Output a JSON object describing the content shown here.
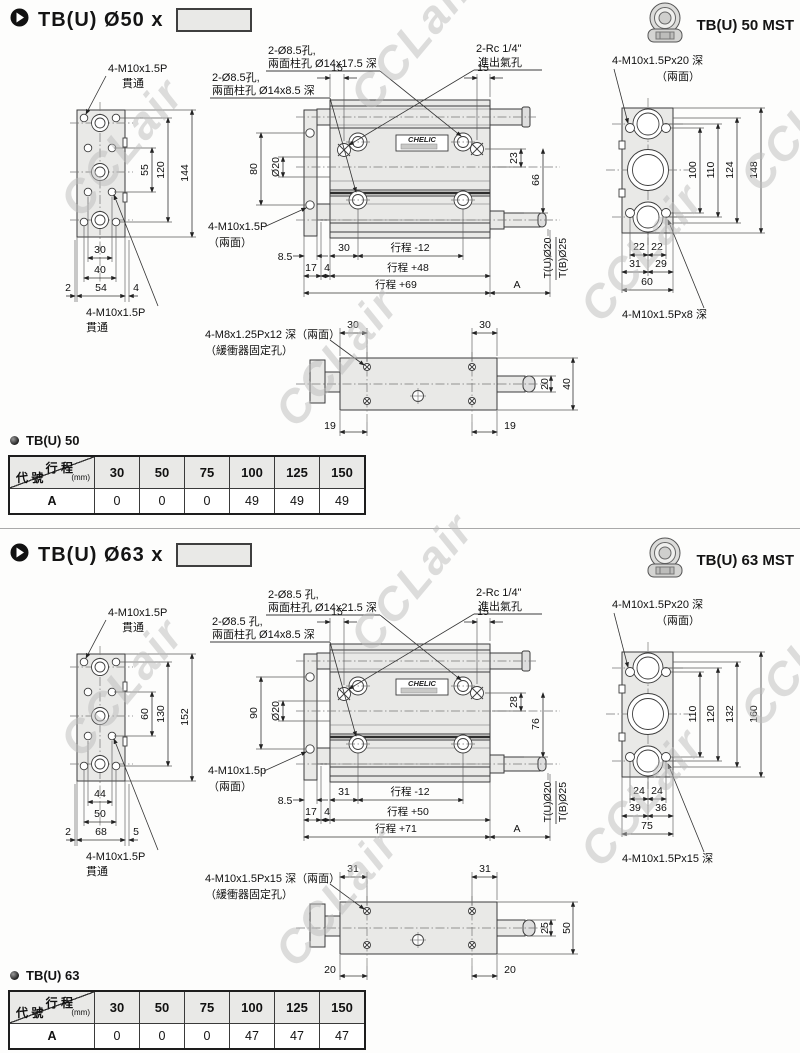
{
  "watermark": "CCLair",
  "section_order": [
    "s50",
    "s63"
  ],
  "sections": {
    "s50": {
      "title": "TB(U) Ø50 x",
      "mst": "TB(U) 50 MST",
      "bullet": "TB(U) 50",
      "lv": {
        "t1": "4-M10x1.5P",
        "t2": "貫通",
        "b1": "4-M10x1.5P",
        "b2": "貫通",
        "v1": "55",
        "v2": "120",
        "v3": "144",
        "h1": "30",
        "h2": "40",
        "e1": "2",
        "e2": "54",
        "e3": "4"
      },
      "fv": {
        "c1a": "2-Ø8.5孔,",
        "c1b": "兩面柱孔 Ø14x17.5 深",
        "c2a": "2-Ø8.5孔,",
        "c2b": "兩面柱孔 Ø14x8.5 深",
        "c3a": "2-Rc 1/4\"",
        "c3b": "進出氣孔",
        "p1": "15",
        "p2": "15",
        "v1": "80",
        "v2": "Ø20",
        "v3": "23",
        "v4": "66",
        "s1": "4-M10x1.5P",
        "s2": "（兩面）",
        "r1a": "8.5",
        "r1b": "30",
        "r1c": "行程 -12",
        "r2a": "17",
        "r2b": "4",
        "r2c": "行程 +48",
        "r3a": "行程 +69",
        "r3b": "A",
        "rod1": "T(U)Ø20",
        "rod2": "T(B)Ø25",
        "plate": "CHELIC"
      },
      "rv": {
        "t1": "4-M10x1.5Px20 深",
        "t2": "（兩面）",
        "v1": "100",
        "v2": "110",
        "v3": "124",
        "v4": "148",
        "h1a": "22",
        "h1b": "22",
        "h2a": "31",
        "h2b": "29",
        "h3": "60",
        "bot": "4-M10x1.5Px8 深"
      },
      "bv": {
        "l1": "4-M8x1.25Px12 深（兩面）",
        "l2": "（緩衝器固定孔）",
        "d1": "30",
        "d2": "30",
        "r1": "20",
        "r2": "40",
        "b1": "19",
        "b2": "19"
      },
      "table": {
        "h_stroke": "行 程",
        "h_unit": "(mm)",
        "h_code": "代 號",
        "cols": [
          "30",
          "50",
          "75",
          "100",
          "125",
          "150"
        ],
        "row": "A",
        "vals": [
          "0",
          "0",
          "0",
          "49",
          "49",
          "49"
        ]
      }
    },
    "s63": {
      "title": "TB(U) Ø63 x",
      "mst": "TB(U) 63 MST",
      "bullet": "TB(U) 63",
      "lv": {
        "t1": "4-M10x1.5P",
        "t2": "貫通",
        "b1": "4-M10x1.5P",
        "b2": "貫通",
        "v1": "60",
        "v2": "130",
        "v3": "152",
        "h1": "44",
        "h2": "50",
        "e1": "2",
        "e2": "68",
        "e3": "5"
      },
      "fv": {
        "c1a": "2-Ø8.5 孔,",
        "c1b": "兩面柱孔 Ø14x21.5 深",
        "c2a": "2-Ø8.5 孔,",
        "c2b": "兩面柱孔 Ø14x8.5 深",
        "c3a": "2-Rc 1/4\"",
        "c3b": "進出氣孔",
        "p1": "15",
        "p2": "15",
        "v1": "90",
        "v2": "Ø20",
        "v3": "28",
        "v4": "76",
        "s1": "4-M10x1.5p",
        "s2": "（兩面）",
        "r1a": "8.5",
        "r1b": "31",
        "r1c": "行程 -12",
        "r2a": "17",
        "r2b": "4",
        "r2c": "行程 +50",
        "r3a": "行程 +71",
        "r3b": "A",
        "rod1": "T(U)Ø20",
        "rod2": "T(B)Ø25",
        "plate": "CHELIC"
      },
      "rv": {
        "t1": "4-M10x1.5Px20 深",
        "t2": "（兩面）",
        "v1": "110",
        "v2": "120",
        "v3": "132",
        "v4": "160",
        "h1a": "24",
        "h1b": "24",
        "h2a": "39",
        "h2b": "36",
        "h3": "75",
        "bot": "4-M10x1.5Px15 深"
      },
      "bv": {
        "l1": "4-M10x1.5Px15 深（兩面）",
        "l2": "（緩衝器固定孔）",
        "d1": "31",
        "d2": "31",
        "r1": "25",
        "r2": "50",
        "b1": "20",
        "b2": "20"
      },
      "table": {
        "h_stroke": "行 程",
        "h_unit": "(mm)",
        "h_code": "代 號",
        "cols": [
          "30",
          "50",
          "75",
          "100",
          "125",
          "150"
        ],
        "row": "A",
        "vals": [
          "0",
          "0",
          "0",
          "47",
          "47",
          "47"
        ]
      }
    }
  }
}
